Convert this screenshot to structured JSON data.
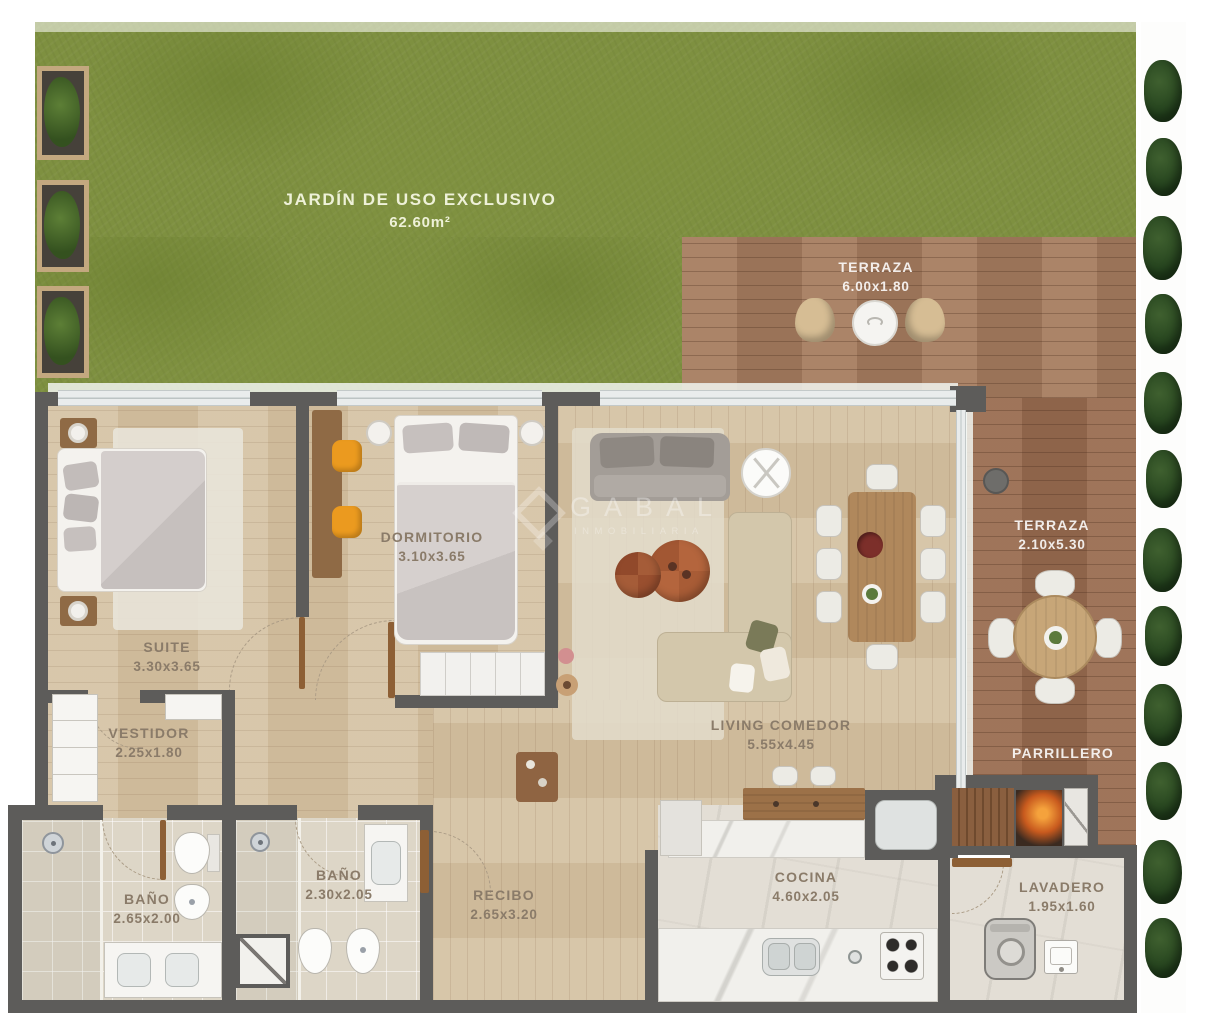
{
  "plan": {
    "watermark": {
      "brand": "GABAL",
      "subtitle": "INMOBILIARIA"
    },
    "rooms": {
      "jardin": {
        "name": "JARDÍN DE USO EXCLUSIVO",
        "dims": "62.60m²"
      },
      "terraza_sup": {
        "name": "TERRAZA",
        "dims": "6.00x1.80"
      },
      "terraza_lat": {
        "name": "TERRAZA",
        "dims": "2.10x5.30"
      },
      "suite": {
        "name": "SUITE",
        "dims": "3.30x3.65"
      },
      "dormitorio": {
        "name": "DORMITORIO",
        "dims": "3.10x3.65"
      },
      "vestidor": {
        "name": "VESTIDOR",
        "dims": "2.25x1.80"
      },
      "bano_suite": {
        "name": "BAÑO",
        "dims": "2.65x2.00"
      },
      "bano_segundo": {
        "name": "BAÑO",
        "dims": "2.30x2.05"
      },
      "recibo": {
        "name": "RECIBO",
        "dims": "2.65x3.20"
      },
      "living": {
        "name": "LIVING COMEDOR",
        "dims": "5.55x4.45"
      },
      "cocina": {
        "name": "COCINA",
        "dims": "4.60x2.05"
      },
      "lavadero": {
        "name": "LAVADERO",
        "dims": "1.95x1.60"
      },
      "parrillero": {
        "name": "PARRILLERO",
        "dims": ""
      }
    },
    "colors": {
      "grass": "#7e9040",
      "deck_wood": "#a67c5f",
      "wall": "#5d5c5a",
      "interior_floor": "#d3bf9f",
      "tile": "#ddd6c7",
      "label_interior": "#8a7b69",
      "label_exterior": "#ffffff",
      "accent_chair": "#eb9a1f"
    }
  }
}
